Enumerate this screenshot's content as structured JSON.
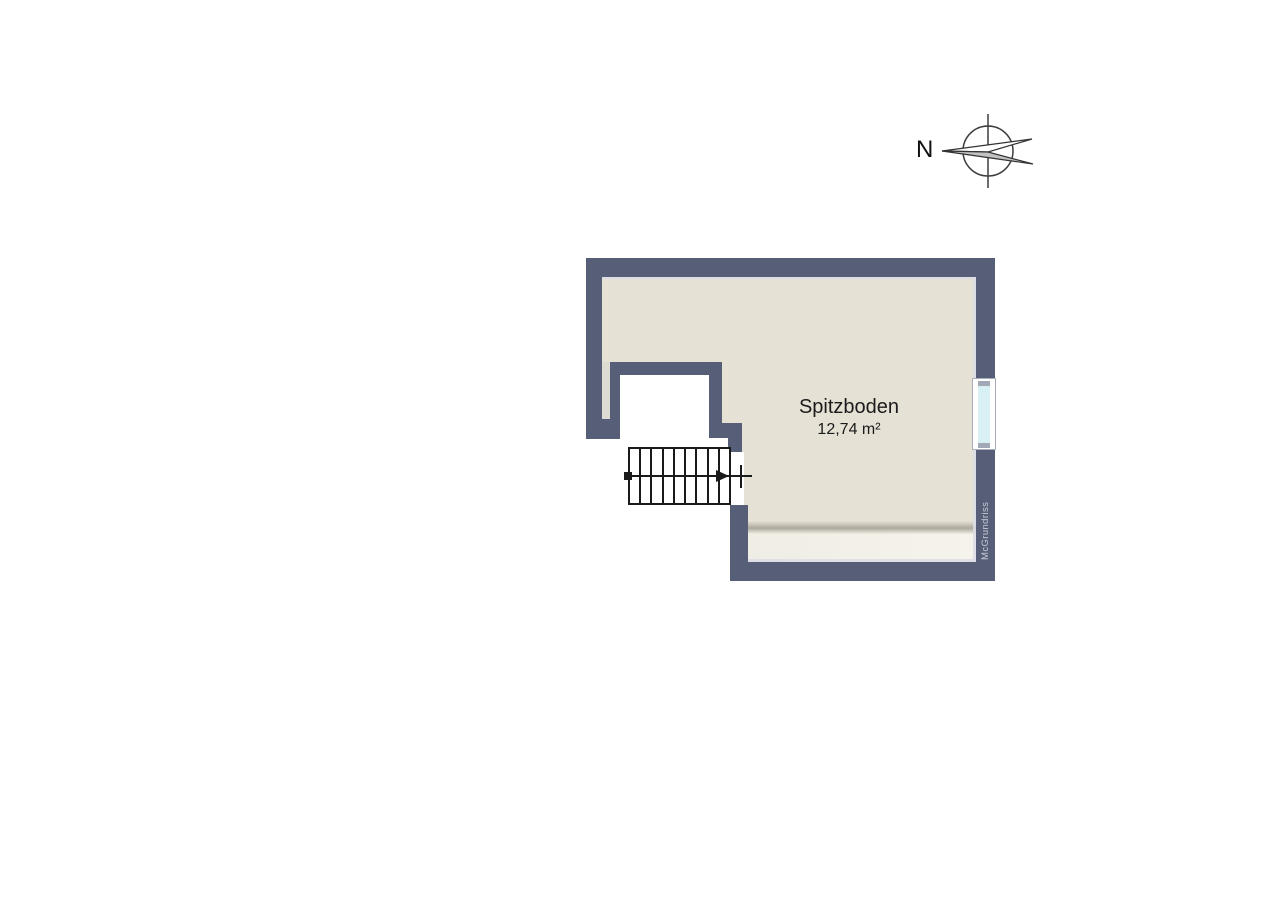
{
  "room": {
    "name": "Spitzboden",
    "area": "12,74 m²"
  },
  "watermark": {
    "label": "McGrundriss"
  },
  "compass": {
    "label": "N",
    "orientation": "north-left"
  },
  "stairs": {
    "treads": 9,
    "direction": "up-to-right"
  },
  "colors": {
    "wall": "#575E78",
    "floor": "#E5E1D5",
    "floor_niche": "#DEDCD2",
    "floor_light": "#F0EDE4",
    "floor_shadow": "#ACA89E",
    "edge_line": "#DCDDE8",
    "stair_line": "#1A1A1A",
    "window_pane": "#D8F0F4",
    "window_cap": "#A2A9B6",
    "watermark_text": "#C9CDD9",
    "needle_gray": "#C2C2C2",
    "label_text": "#1B1B1B"
  }
}
